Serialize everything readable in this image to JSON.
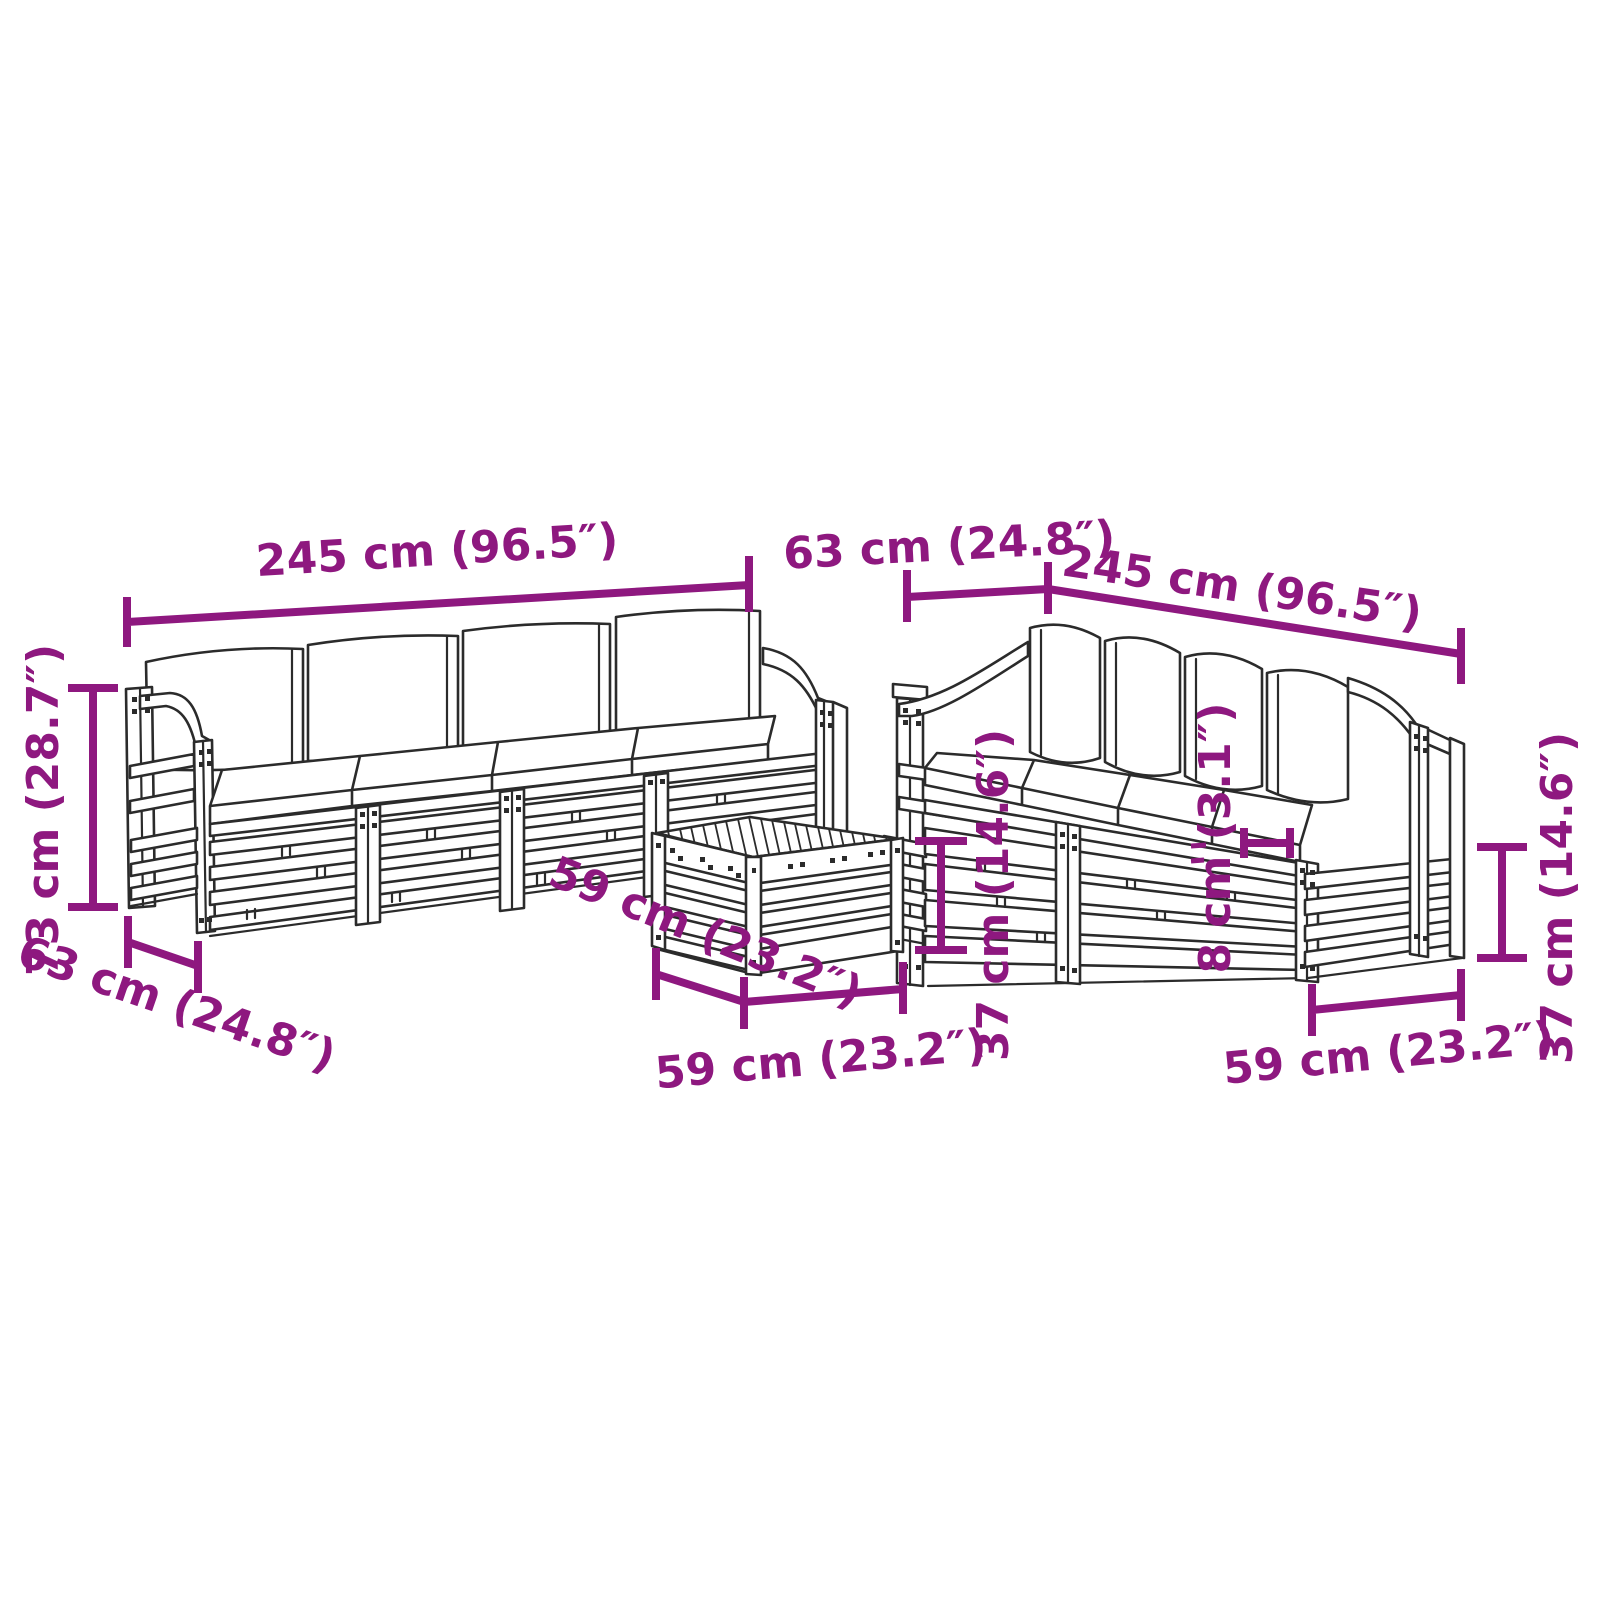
{
  "diagram": {
    "type": "product-dimension-diagram",
    "subject": "garden pallet lounge set: two 4-seater sofas with cushions and a coffee table",
    "colors": {
      "background": "#ffffff",
      "line_art": "#2b2b2b",
      "dimension_accent": "#8E187F"
    }
  },
  "dimensions": {
    "sofa_left_width": "245 cm (96.5″)",
    "aisle_depth": "63 cm (24.8″)",
    "sofa_right_width": "245 cm (96.5″)",
    "sofa_height": "73 cm (28.7″)",
    "sofa_depth": "63 cm (24.8″)",
    "table_depth": "59 cm (23.2″)",
    "table_width": "59 cm (23.2″)",
    "table_height": "37 cm (14.6″)",
    "cushion_thickness": "8 cm (3.1″)",
    "module_width": "59 cm (23.2″)",
    "seat_height": "37 cm (14.6″)"
  }
}
